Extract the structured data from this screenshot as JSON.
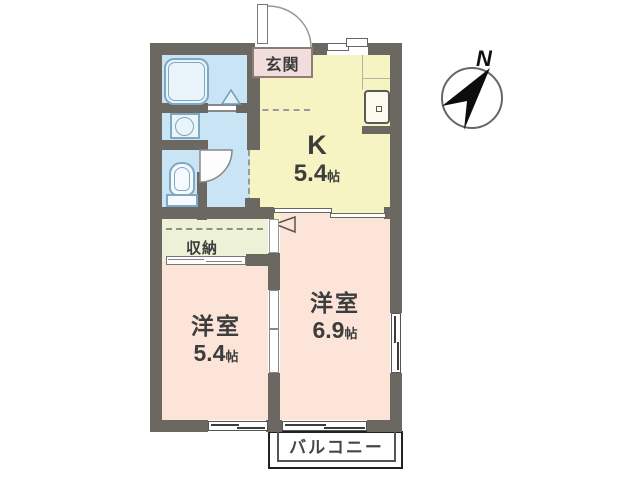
{
  "plan_type": "apartment-floorplan",
  "compass": {
    "label": "N"
  },
  "rooms": {
    "genkan": {
      "label": "玄関"
    },
    "kitchen": {
      "label": "K",
      "size": "5.4",
      "unit": "帖"
    },
    "western_room_large": {
      "label": "洋室",
      "size": "6.9",
      "unit": "帖"
    },
    "western_room_small": {
      "label": "洋室",
      "size": "5.4",
      "unit": "帖"
    },
    "closet": {
      "label": "収納"
    },
    "balcony": {
      "label": "バルコニー"
    }
  },
  "fixtures": [
    "bathtub",
    "washbasin",
    "toilet",
    "refrigerator",
    "entrance-door",
    "toilet-door",
    "sliding-doors",
    "windows"
  ],
  "colors": {
    "wall": "#6b6862",
    "wet_area": "#c9e4f4",
    "kitchen_area": "#f7f4c3",
    "western_rooms": "#fce5d8",
    "closet_area": "#edf1d8",
    "genkan_bg": "#f2dddd",
    "fixture_outline": "#7fa8c2",
    "balcony_border": "#222222"
  }
}
